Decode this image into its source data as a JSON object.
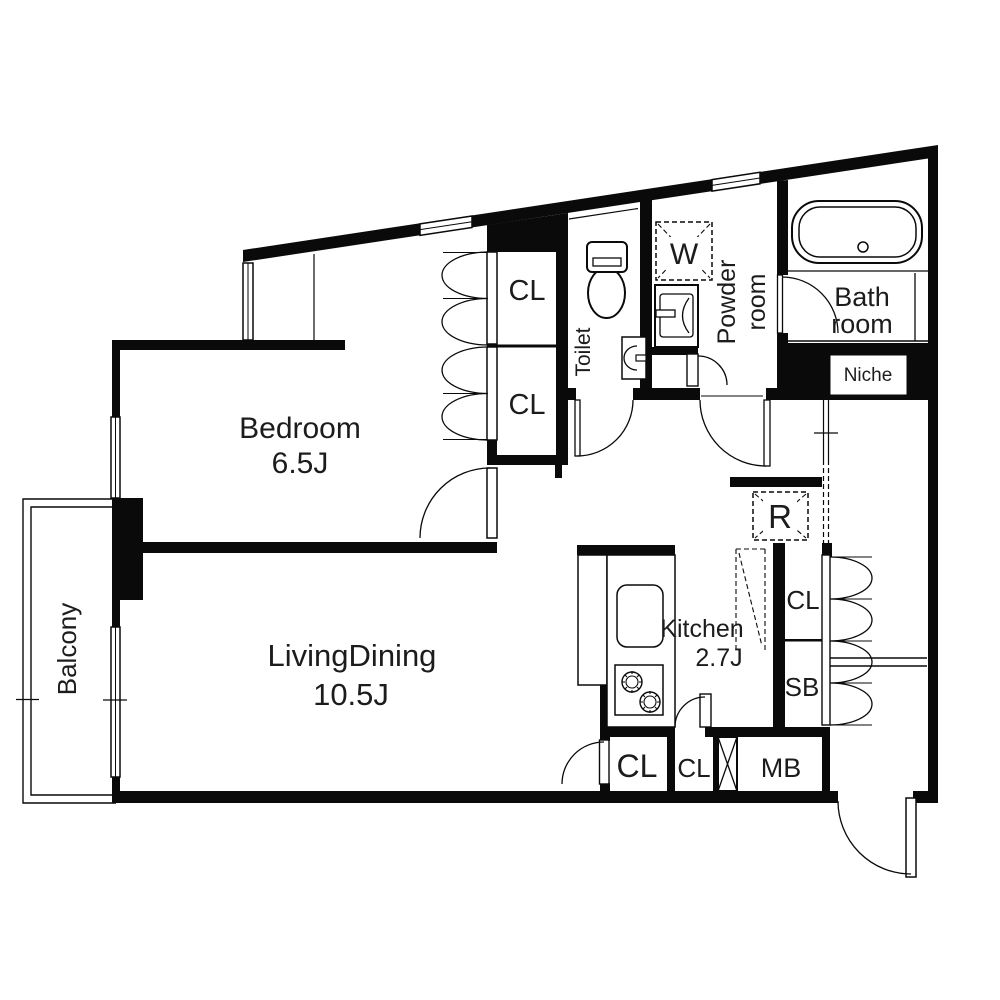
{
  "floor_plan": {
    "rooms": {
      "bedroom": {
        "name": "Bedroom",
        "size": "6.5J"
      },
      "living_dining": {
        "name": "LivingDining",
        "size": "10.5J"
      },
      "kitchen": {
        "name": "Kitchen",
        "size": "2.7J"
      },
      "balcony": {
        "name": "Balcony"
      },
      "toilet": {
        "name": "Toilet"
      },
      "powder_room": {
        "line1": "Powder",
        "line2": "room"
      },
      "bath_room": {
        "line1": "Bath",
        "line2": "room"
      },
      "niche": {
        "name": "Niche"
      }
    },
    "storage": {
      "bedroom_closet_upper": "CL",
      "bedroom_closet_lower": "CL",
      "hall_closet": "CL",
      "kitchen_closet": "CL",
      "corridor_closet": "CL",
      "shoe_box": "SB",
      "meter_box": "MB"
    },
    "appliances": {
      "washing_machine": "W",
      "refrigerator": "R"
    },
    "colors": {
      "wall": "#0a0a0a",
      "text": "#1c1c1c",
      "background": "#ffffff"
    }
  }
}
